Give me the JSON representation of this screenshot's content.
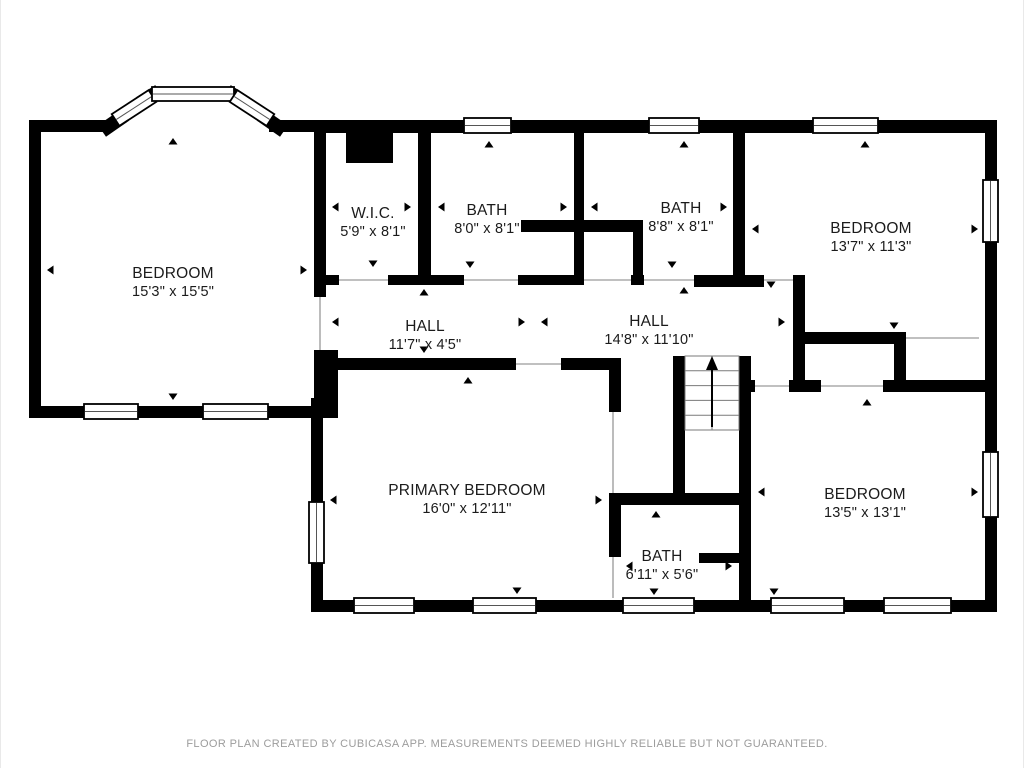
{
  "meta": {
    "footer": "FLOOR PLAN CREATED BY CUBICASA APP. MEASUREMENTS DEEMED HIGHLY RELIABLE BUT NOT GUARANTEED.",
    "footer_x": 506,
    "footer_y": 747
  },
  "colors": {
    "wall": "#000000",
    "bg": "#ffffff",
    "text": "#1b1b1b",
    "muted": "#9c9c9c",
    "opening_line": "#ababab",
    "window_mid": "#555555",
    "stair_line": "#7a7a7a"
  },
  "rooms": [
    {
      "id": "bedroom-top-left",
      "name": "BEDROOM",
      "dims": "15'3\" x 15'5\"",
      "cx": 172,
      "cy": 278
    },
    {
      "id": "wic",
      "name": "W.I.C.",
      "dims": "5'9\" x 8'1\"",
      "cx": 372,
      "cy": 218
    },
    {
      "id": "bath-top-left",
      "name": "BATH",
      "dims": "8'0\" x 8'1\"",
      "cx": 486,
      "cy": 215
    },
    {
      "id": "bath-top-middle",
      "name": "BATH",
      "dims": "8'8\" x 8'1\"",
      "cx": 680,
      "cy": 213
    },
    {
      "id": "bedroom-top-right",
      "name": "BEDROOM",
      "dims": "13'7\" x 11'3\"",
      "cx": 870,
      "cy": 233
    },
    {
      "id": "hall-west",
      "name": "HALL",
      "dims": "11'7\" x 4'5\"",
      "cx": 424,
      "cy": 331
    },
    {
      "id": "hall-east",
      "name": "HALL",
      "dims": "14'8\" x 11'10\"",
      "cx": 648,
      "cy": 326
    },
    {
      "id": "primary-bedroom",
      "name": "PRIMARY BEDROOM",
      "dims": "16'0\" x 12'11\"",
      "cx": 466,
      "cy": 495
    },
    {
      "id": "bath-bottom",
      "name": "BATH",
      "dims": "6'11\" x 5'6\"",
      "cx": 661,
      "cy": 561
    },
    {
      "id": "bedroom-bottom-right",
      "name": "BEDROOM",
      "dims": "13'5\" x 13'1\"",
      "cx": 864,
      "cy": 499
    }
  ],
  "geometry": {
    "walls": [
      [
        28,
        120,
        12,
        298
      ],
      [
        28,
        406,
        297,
        12
      ],
      [
        28,
        120,
        84,
        12
      ],
      [
        268,
        120,
        57,
        12
      ],
      [
        313,
        120,
        683,
        13
      ],
      [
        984,
        120,
        12,
        492
      ],
      [
        310,
        600,
        686,
        12
      ],
      [
        310,
        398,
        12,
        202
      ],
      [
        313,
        350,
        24,
        68
      ],
      [
        313,
        133,
        12,
        164
      ],
      [
        345,
        133,
        47,
        30
      ],
      [
        417,
        133,
        13,
        152
      ],
      [
        313,
        275,
        25,
        10
      ],
      [
        387,
        275,
        76,
        10
      ],
      [
        517,
        275,
        66,
        10
      ],
      [
        630,
        275,
        13,
        10
      ],
      [
        693,
        275,
        70,
        12
      ],
      [
        520,
        220,
        122,
        12
      ],
      [
        632,
        232,
        10,
        46
      ],
      [
        573,
        133,
        10,
        152
      ],
      [
        732,
        133,
        12,
        152
      ],
      [
        792,
        275,
        12,
        117
      ],
      [
        792,
        332,
        113,
        12
      ],
      [
        893,
        332,
        12,
        60
      ],
      [
        738,
        380,
        16,
        12
      ],
      [
        788,
        380,
        32,
        12
      ],
      [
        882,
        380,
        114,
        12
      ],
      [
        337,
        358,
        178,
        12
      ],
      [
        560,
        358,
        58,
        12
      ],
      [
        608,
        358,
        12,
        54
      ],
      [
        608,
        493,
        140,
        12
      ],
      [
        608,
        505,
        12,
        52
      ],
      [
        672,
        356,
        12,
        149
      ],
      [
        738,
        356,
        12,
        244
      ],
      [
        698,
        553,
        42,
        10
      ]
    ],
    "windows": [
      [
        463,
        118,
        47,
        15
      ],
      [
        648,
        118,
        50,
        15
      ],
      [
        812,
        118,
        65,
        15
      ],
      [
        982,
        180,
        15,
        62
      ],
      [
        982,
        452,
        15,
        65
      ],
      [
        353,
        598,
        60,
        15
      ],
      [
        472,
        598,
        63,
        15
      ],
      [
        622,
        598,
        71,
        15
      ],
      [
        770,
        598,
        73,
        15
      ],
      [
        883,
        598,
        67,
        15
      ],
      [
        308,
        502,
        15,
        61
      ],
      [
        83,
        404,
        54,
        15
      ],
      [
        202,
        404,
        65,
        15
      ]
    ],
    "bay": {
      "stubs": [
        [
          101,
          131,
          124,
          115
        ],
        [
          139,
          103,
          158,
          91
        ],
        [
          226,
          91,
          245,
          103
        ],
        [
          260,
          115,
          283,
          131
        ]
      ],
      "windows": [
        {
          "cx": 133,
          "cy": 108,
          "len": 44,
          "th": 14,
          "angle": -33
        },
        {
          "cx": 192,
          "cy": 94,
          "len": 82,
          "th": 14,
          "angle": 0
        },
        {
          "cx": 251,
          "cy": 108,
          "len": 44,
          "th": 14,
          "angle": 33
        }
      ]
    },
    "openings": [
      {
        "x1": 338,
        "y1": 280,
        "x2": 387,
        "y2": 280
      },
      {
        "x1": 463,
        "y1": 280,
        "x2": 517,
        "y2": 280
      },
      {
        "x1": 583,
        "y1": 280,
        "x2": 630,
        "y2": 280
      },
      {
        "x1": 643,
        "y1": 280,
        "x2": 693,
        "y2": 280
      },
      {
        "x1": 763,
        "y1": 280,
        "x2": 792,
        "y2": 280
      },
      {
        "x1": 319,
        "y1": 297,
        "x2": 319,
        "y2": 350
      },
      {
        "x1": 515,
        "y1": 364,
        "x2": 560,
        "y2": 364
      },
      {
        "x1": 612,
        "y1": 412,
        "x2": 612,
        "y2": 493
      },
      {
        "x1": 612,
        "y1": 557,
        "x2": 612,
        "y2": 598
      },
      {
        "x1": 905,
        "y1": 338,
        "x2": 978,
        "y2": 338
      },
      {
        "x1": 754,
        "y1": 386,
        "x2": 788,
        "y2": 386
      },
      {
        "x1": 820,
        "y1": 386,
        "x2": 882,
        "y2": 386
      }
    ],
    "arrows": [
      {
        "x": 172,
        "y": 138,
        "dir": "up"
      },
      {
        "x": 172,
        "y": 400,
        "dir": "down"
      },
      {
        "x": 46,
        "y": 270,
        "dir": "left"
      },
      {
        "x": 306,
        "y": 270,
        "dir": "right"
      },
      {
        "x": 372,
        "y": 141,
        "dir": "up"
      },
      {
        "x": 372,
        "y": 267,
        "dir": "down"
      },
      {
        "x": 331,
        "y": 207,
        "dir": "left"
      },
      {
        "x": 410,
        "y": 207,
        "dir": "right"
      },
      {
        "x": 488,
        "y": 141,
        "dir": "up"
      },
      {
        "x": 469,
        "y": 268,
        "dir": "down"
      },
      {
        "x": 437,
        "y": 207,
        "dir": "left"
      },
      {
        "x": 566,
        "y": 207,
        "dir": "right"
      },
      {
        "x": 683,
        "y": 141,
        "dir": "up"
      },
      {
        "x": 671,
        "y": 268,
        "dir": "down"
      },
      {
        "x": 590,
        "y": 207,
        "dir": "left"
      },
      {
        "x": 726,
        "y": 207,
        "dir": "right"
      },
      {
        "x": 864,
        "y": 141,
        "dir": "up"
      },
      {
        "x": 893,
        "y": 329,
        "dir": "down"
      },
      {
        "x": 751,
        "y": 229,
        "dir": "left"
      },
      {
        "x": 977,
        "y": 229,
        "dir": "right"
      },
      {
        "x": 423,
        "y": 289,
        "dir": "up"
      },
      {
        "x": 423,
        "y": 353,
        "dir": "down"
      },
      {
        "x": 331,
        "y": 322,
        "dir": "left"
      },
      {
        "x": 524,
        "y": 322,
        "dir": "right"
      },
      {
        "x": 683,
        "y": 287,
        "dir": "up"
      },
      {
        "x": 770,
        "y": 288,
        "dir": "down"
      },
      {
        "x": 540,
        "y": 322,
        "dir": "left"
      },
      {
        "x": 784,
        "y": 322,
        "dir": "right"
      },
      {
        "x": 467,
        "y": 377,
        "dir": "up"
      },
      {
        "x": 516,
        "y": 594,
        "dir": "down"
      },
      {
        "x": 329,
        "y": 500,
        "dir": "left"
      },
      {
        "x": 601,
        "y": 500,
        "dir": "right"
      },
      {
        "x": 655,
        "y": 511,
        "dir": "up"
      },
      {
        "x": 653,
        "y": 595,
        "dir": "down"
      },
      {
        "x": 625,
        "y": 566,
        "dir": "left"
      },
      {
        "x": 731,
        "y": 566,
        "dir": "right"
      },
      {
        "x": 866,
        "y": 399,
        "dir": "up"
      },
      {
        "x": 773,
        "y": 595,
        "dir": "down"
      },
      {
        "x": 757,
        "y": 492,
        "dir": "left"
      },
      {
        "x": 977,
        "y": 492,
        "dir": "right"
      }
    ],
    "stairs": {
      "x": 684,
      "y": 356,
      "w": 54,
      "h": 74,
      "rows": 5,
      "midx": 711,
      "arrow": {
        "x": 711,
        "y1": 427,
        "y2": 368
      }
    }
  }
}
